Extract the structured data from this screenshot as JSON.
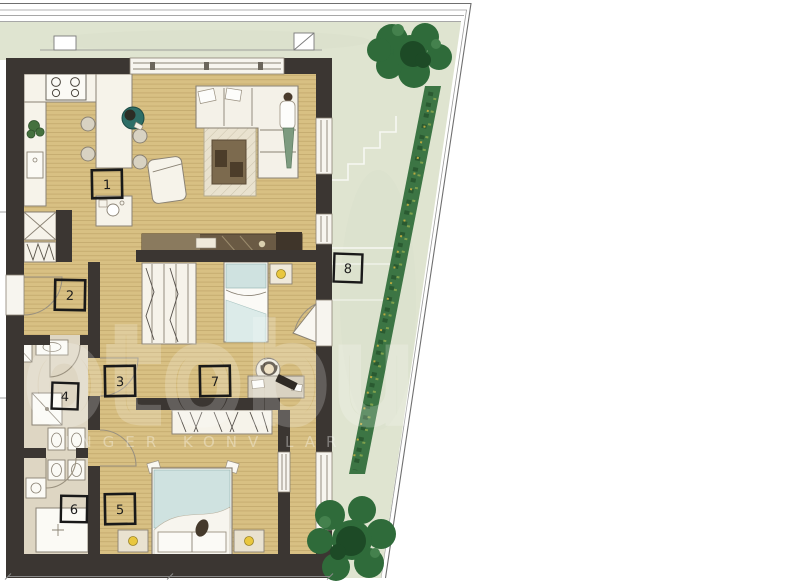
{
  "room_labels": [
    "1",
    "2",
    "3",
    "4",
    "5",
    "6",
    "7",
    "8"
  ],
  "watermark": {
    "main": "otobu",
    "sub": "INGER KONV LAR"
  },
  "colors": {
    "wall": "#3b3632",
    "wood_floor": "#d8c083",
    "plank_line": "#b59a5e",
    "lawn": "#dfe4d0",
    "hedge": "#3c7544",
    "tree": "#2f6b3a",
    "tree_core": "#1d4a26",
    "bath_floor": "#ded6c3",
    "bedding_blue": "#cfe2e0",
    "lamp_yellow": "#e9c73e",
    "chair_teal": "#2e6e67"
  }
}
